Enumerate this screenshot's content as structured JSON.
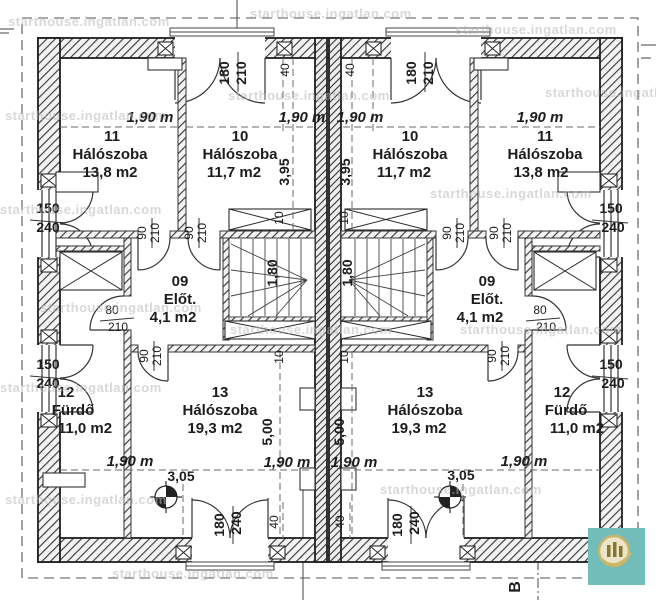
{
  "watermark": {
    "text": "starthouse.ingatlan.com"
  },
  "branding": {
    "logo_bg": "#72bdb9",
    "logo_ring": "#c9b469",
    "logo_fill": "#ece5c8",
    "logo_bars": "#857636"
  },
  "plan": {
    "section_marker": "B",
    "rooms": [
      {
        "number": "11",
        "name": "Hálószoba",
        "area": "13,8 m2"
      },
      {
        "number": "10",
        "name": "Hálószoba",
        "area": "11,7 m2"
      },
      {
        "number": "09",
        "name": "Előt.",
        "area": "4,1 m2"
      },
      {
        "number": "13",
        "name": "Hálószoba",
        "area": "19,3 m2"
      },
      {
        "number": "12",
        "name": "Fürdő",
        "area": "11,0 m2"
      }
    ],
    "dims": {
      "bed_width": "1,90 m",
      "depth_top": "3,95",
      "depth_bottom": "5,00",
      "bottom_width": "3,05",
      "gap": "40",
      "wall": "10",
      "stair_width": "1,80"
    },
    "openings": {
      "balcony_door": {
        "w": "180",
        "h": "210"
      },
      "terrace_door": {
        "w": "180",
        "h": "240"
      },
      "room_door": {
        "w": "90",
        "h": "210"
      },
      "bath_door": {
        "w": "80",
        "h": "210"
      },
      "window": {
        "w": "150",
        "h": "240"
      }
    }
  }
}
